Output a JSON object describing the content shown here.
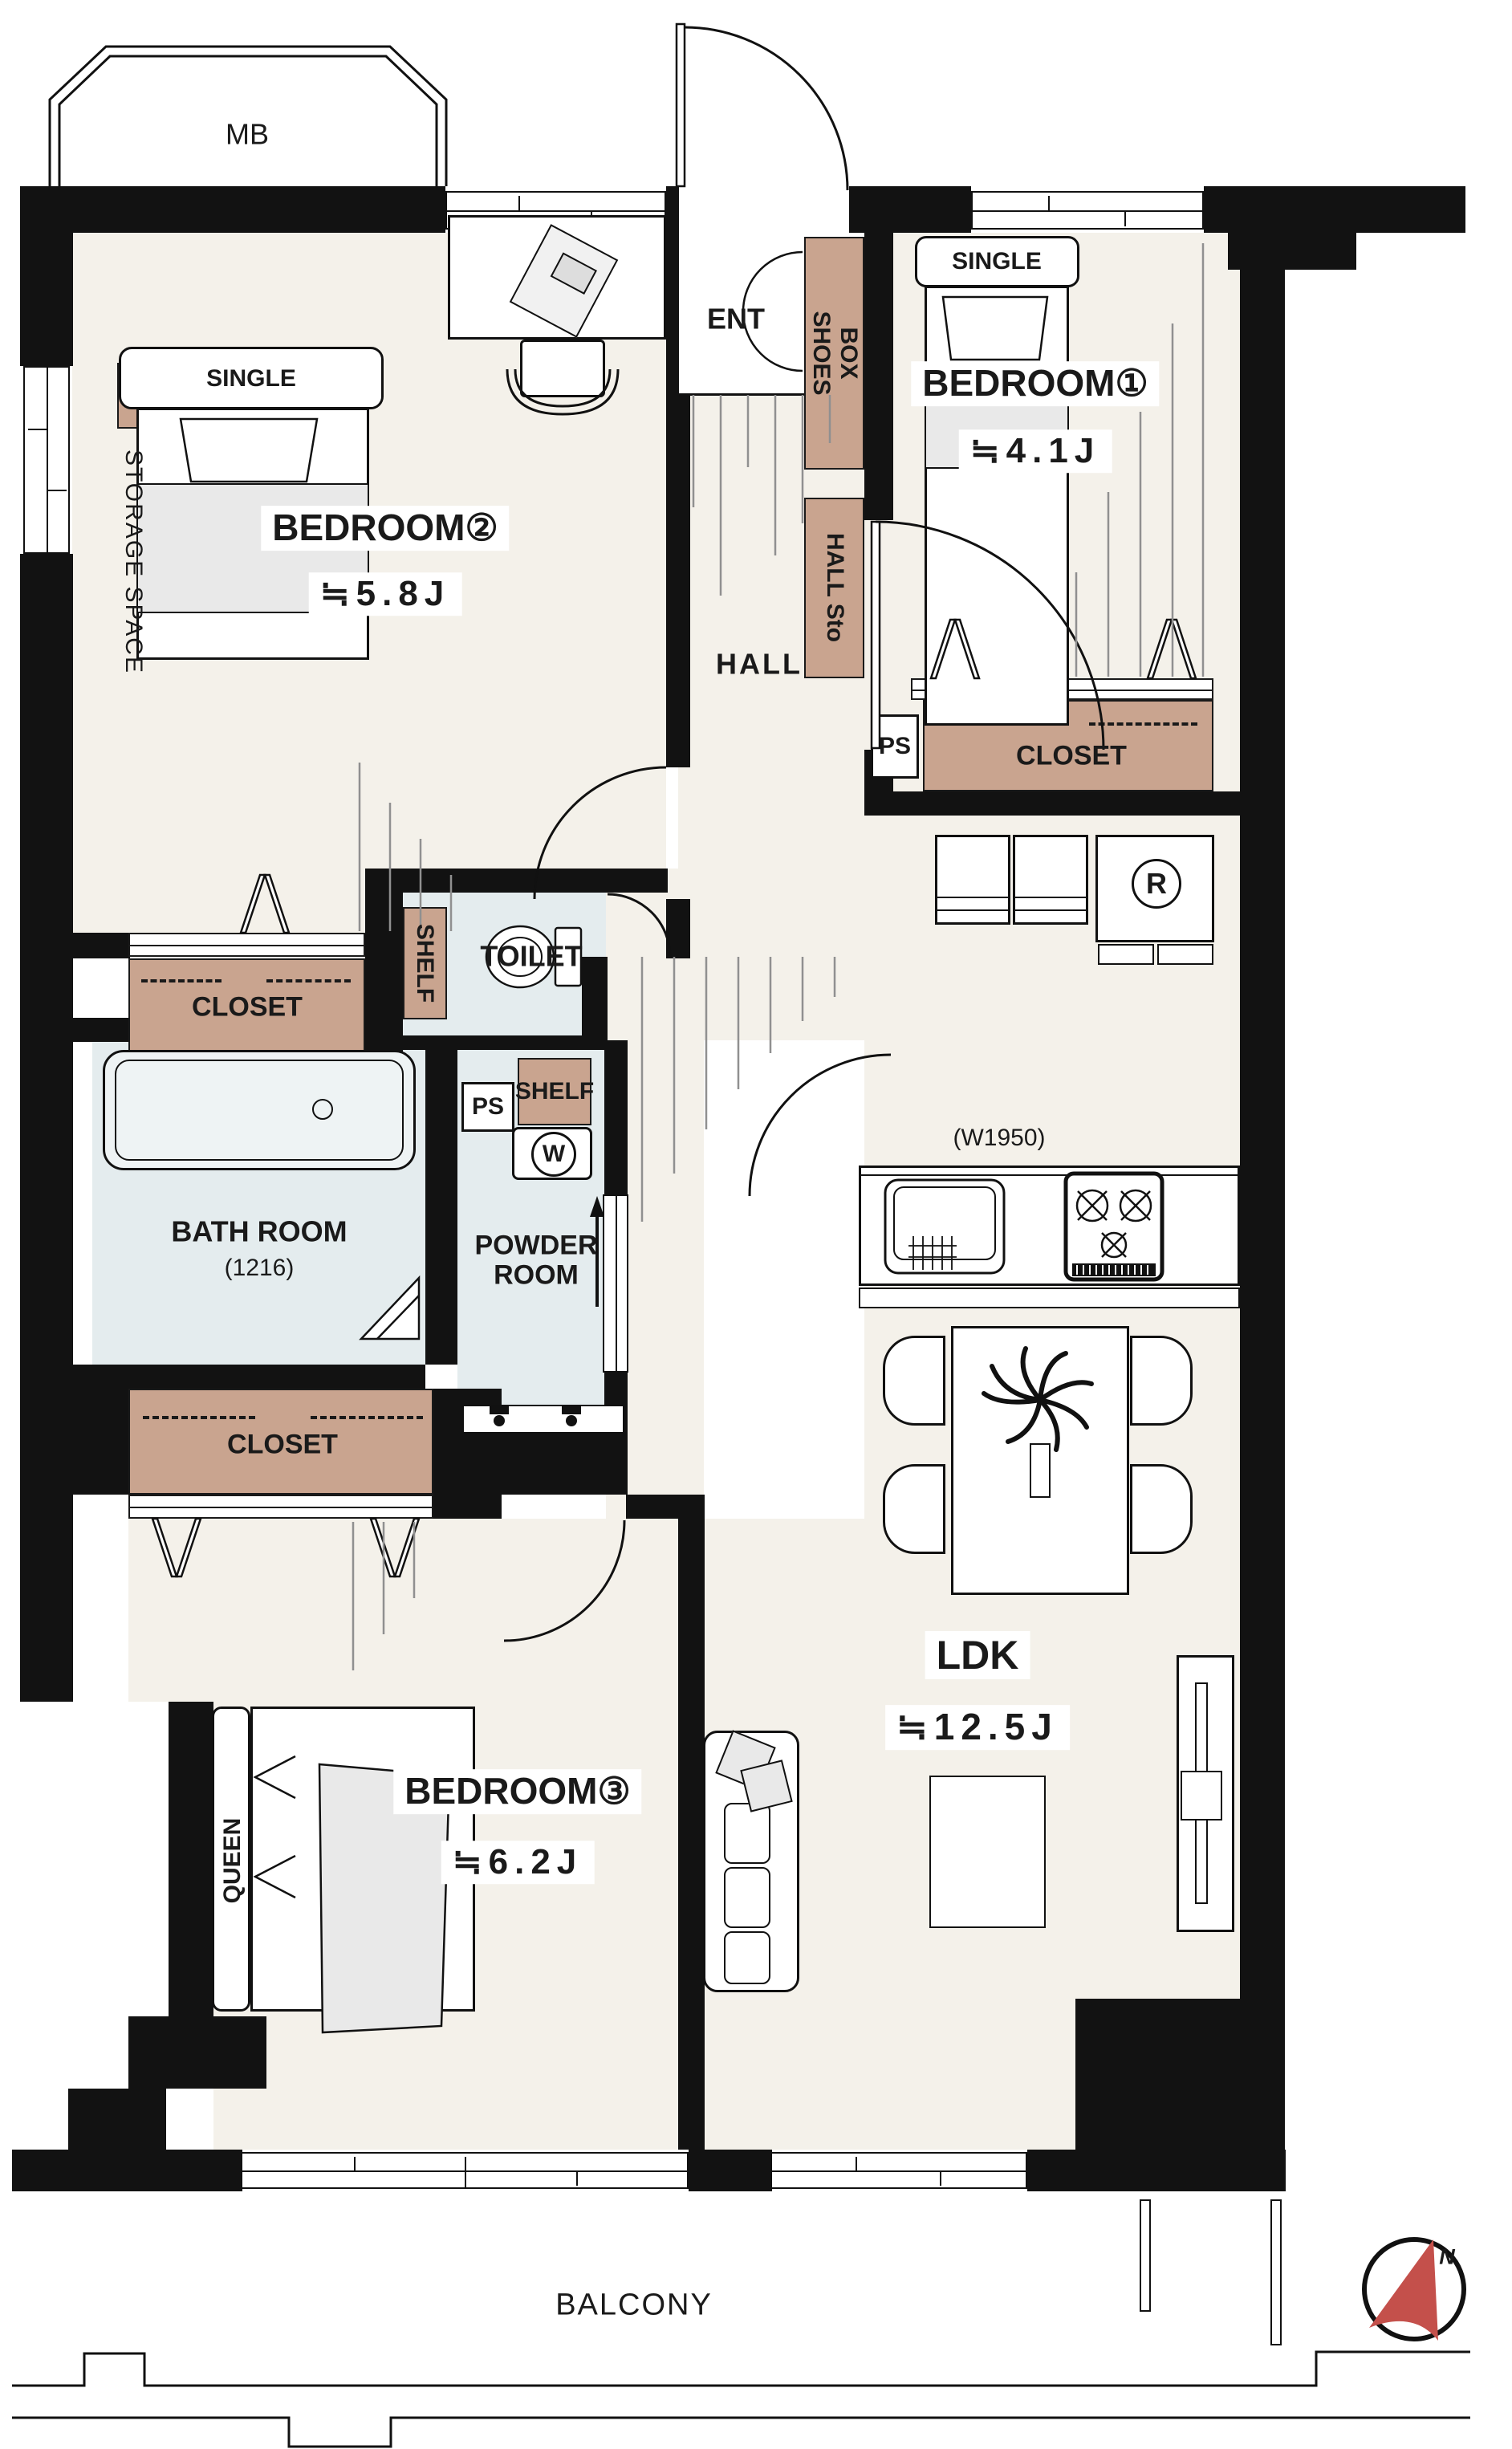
{
  "colors": {
    "wall": "#121212",
    "floor": "#f4f1ea",
    "wet_area": "#e4ecee",
    "storage": "#c9a48f",
    "compass_red": "#c4504b"
  },
  "plan": {
    "meter_box": "MB",
    "legend": {
      "storage_space": "STORAGE SPACE"
    },
    "entrance": {
      "label": "ENT",
      "shoes_box_line1": "SHOES",
      "shoes_box_line2": "BOX",
      "hall_storage": "HALL Sto"
    },
    "hall": {
      "label": "HALL"
    },
    "bedroom1": {
      "name": "BEDROOM①",
      "area": "≒4.1J",
      "bed": "SINGLE",
      "closet": "CLOSET",
      "pipe_space": "PS"
    },
    "bedroom2": {
      "name": "BEDROOM②",
      "area": "≒5.8J",
      "bed": "SINGLE",
      "closet": "CLOSET"
    },
    "bedroom3": {
      "name": "BEDROOM③",
      "area": "≒6.2J",
      "bed": "QUEEN",
      "closet": "CLOSET"
    },
    "ldk": {
      "name": "LDK",
      "area": "≒12.5J",
      "kitchen_width": "(W1950)",
      "refrigerator": "R"
    },
    "toilet": {
      "label": "TOILET",
      "shelf": "SHELF"
    },
    "bath": {
      "name": "BATH ROOM",
      "size": "(1216)"
    },
    "powder_room": {
      "name": "POWDER ROOM",
      "shelf": "SHELF",
      "pipe_space": "PS",
      "washer": "W"
    },
    "balcony": {
      "label": "BALCONY"
    },
    "compass": {
      "north": "N"
    }
  }
}
